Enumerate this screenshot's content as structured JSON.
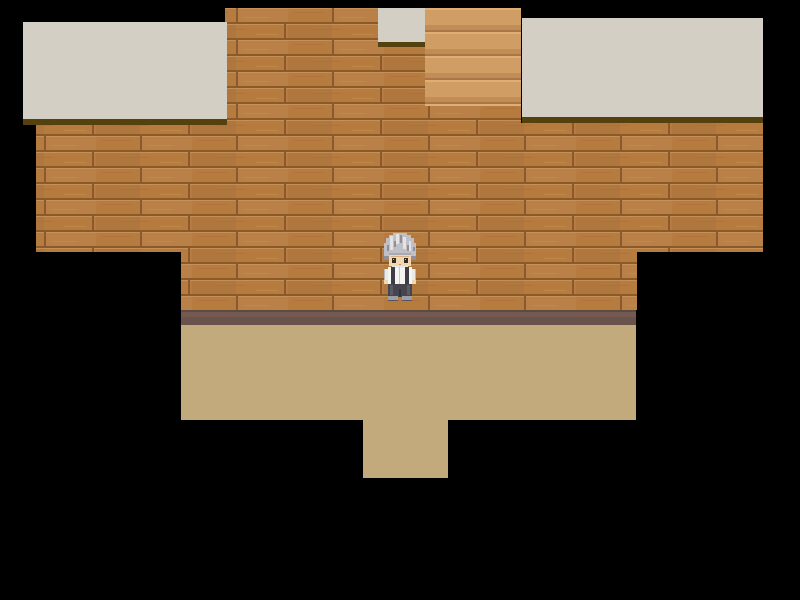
{
  "scene": {
    "description": "Top-down pixel RPG interior scene: large horizontal-plank wooden wall with two pale rooftop ledges above, a wooden staircase opening at top center, a dark baseboard strip, a tan floor room below with a doorway passage at bottom center, and a small character standing in front of the wall",
    "viewport": {
      "width": 800,
      "height": 600,
      "background": "#000000"
    },
    "palette": {
      "void": "#000000",
      "ceiling": "#d3cfc4",
      "ceiling_shadow": "#54410e",
      "wall_base": "#b67b3f",
      "wall_seam": "#8a5a2c",
      "wall_highlight": "#c9935a",
      "stairs_base": "#d09d64",
      "stairs_light": "#dfae73",
      "stairs_mid_shadow": "#c28c55",
      "stairs_edge": "#a9764a",
      "baseboard": "#6e5650",
      "floor": "#c3aa7c"
    },
    "regions": [
      {
        "name": "wall-left",
        "kind": "wall",
        "x": 36,
        "y": 125,
        "w": 145,
        "h": 127,
        "walkable": false
      },
      {
        "name": "wall-left-inner",
        "kind": "wall",
        "x": 181,
        "y": 125,
        "w": 44,
        "h": 185,
        "walkable": false
      },
      {
        "name": "wall-center",
        "kind": "wall",
        "x": 225,
        "y": 8,
        "w": 296,
        "h": 302,
        "walkable": false
      },
      {
        "name": "wall-right-inner",
        "kind": "wall",
        "x": 521,
        "y": 123,
        "w": 116,
        "h": 187,
        "walkable": false
      },
      {
        "name": "wall-right",
        "kind": "wall",
        "x": 637,
        "y": 123,
        "w": 126,
        "h": 129,
        "walkable": false
      },
      {
        "name": "staircase",
        "kind": "stairs",
        "x": 425,
        "y": 8,
        "w": 96,
        "h": 98,
        "walkable": true
      },
      {
        "name": "ceiling-ledge-left",
        "kind": "ceiling",
        "x": 23,
        "y": 22,
        "w": 204,
        "h": 97,
        "walkable": false
      },
      {
        "name": "ceiling-shadow-left",
        "kind": "shadow",
        "x": 23,
        "y": 119,
        "w": 204,
        "h": 6,
        "walkable": false
      },
      {
        "name": "ceiling-ledge-right",
        "kind": "ceiling",
        "x": 522,
        "y": 18,
        "w": 241,
        "h": 99,
        "walkable": false
      },
      {
        "name": "ceiling-shadow-right",
        "kind": "shadow",
        "x": 522,
        "y": 117,
        "w": 241,
        "h": 6,
        "walkable": false
      },
      {
        "name": "ceiling-block-top",
        "kind": "ceiling",
        "x": 378,
        "y": 8,
        "w": 47,
        "h": 34,
        "walkable": false
      },
      {
        "name": "ceiling-block-shadow",
        "kind": "shadow",
        "x": 378,
        "y": 42,
        "w": 47,
        "h": 5,
        "walkable": false
      },
      {
        "name": "baseboard",
        "kind": "baseboard",
        "x": 181,
        "y": 310,
        "w": 455,
        "h": 15,
        "walkable": false
      },
      {
        "name": "floor-main",
        "kind": "floor",
        "x": 181,
        "y": 325,
        "w": 455,
        "h": 95,
        "walkable": true
      },
      {
        "name": "floor-doorway",
        "kind": "floor",
        "x": 363,
        "y": 420,
        "w": 85,
        "h": 58,
        "walkable": true
      }
    ],
    "character": {
      "name": "player-character",
      "appearance": "small pixel-art person facing down: silver-gray tousled hair, pale skin, white shirt with dark suspender straps, white sleeves, dark gray trousers, gray shoes",
      "x": 382,
      "y": 233,
      "width": 36,
      "height": 69,
      "colors": {
        "hair": "#bfbfc5",
        "hair_light": "#e3e3e6",
        "hair_shade": "#8f8f97",
        "skin": "#f2d6ac",
        "skin_shade": "#d9b188",
        "eyes": "#2e2a26",
        "shirt": "#f4f4f2",
        "straps": "#3e3c44",
        "pants": "#45454f",
        "pants_dark": "#33333b",
        "shoes": "#9d9da3"
      }
    }
  }
}
